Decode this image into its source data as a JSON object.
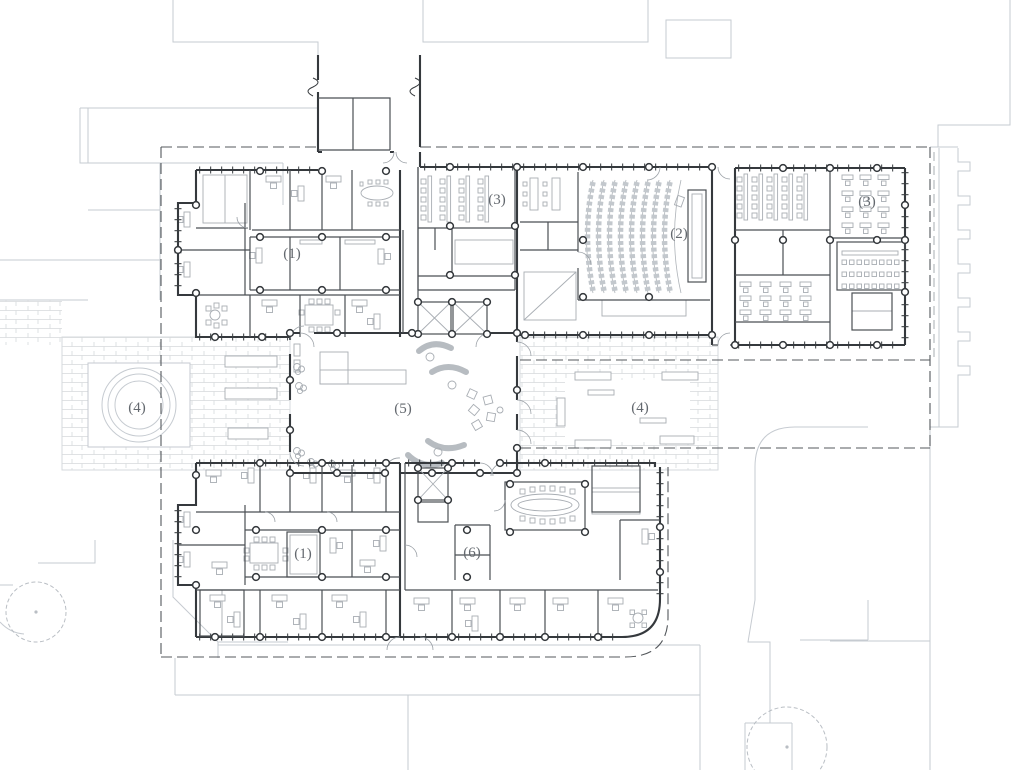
{
  "drawing": {
    "kind": "architectural ground floor plan",
    "background": "#ffffff"
  },
  "plan_labels": [
    {
      "id": "north-office-suite",
      "text": "(1)"
    },
    {
      "id": "auditorium",
      "text": "(2)"
    },
    {
      "id": "classroom-west",
      "text": "(3)"
    },
    {
      "id": "classroom-east",
      "text": "(3)"
    },
    {
      "id": "courtyard-west",
      "text": "(4)"
    },
    {
      "id": "terrace-east",
      "text": "(4)"
    },
    {
      "id": "atrium",
      "text": "(5)"
    },
    {
      "id": "south-office-suite",
      "text": "(1)"
    },
    {
      "id": "south-open-area",
      "text": "(6)"
    }
  ],
  "colors": {
    "walls": "#35393d",
    "site_context": "#c6cbd1",
    "furniture": "#a8adb3",
    "paving": "#d6d9dc",
    "label_text": "#63686e",
    "canopy_dashed": "#54585c"
  }
}
